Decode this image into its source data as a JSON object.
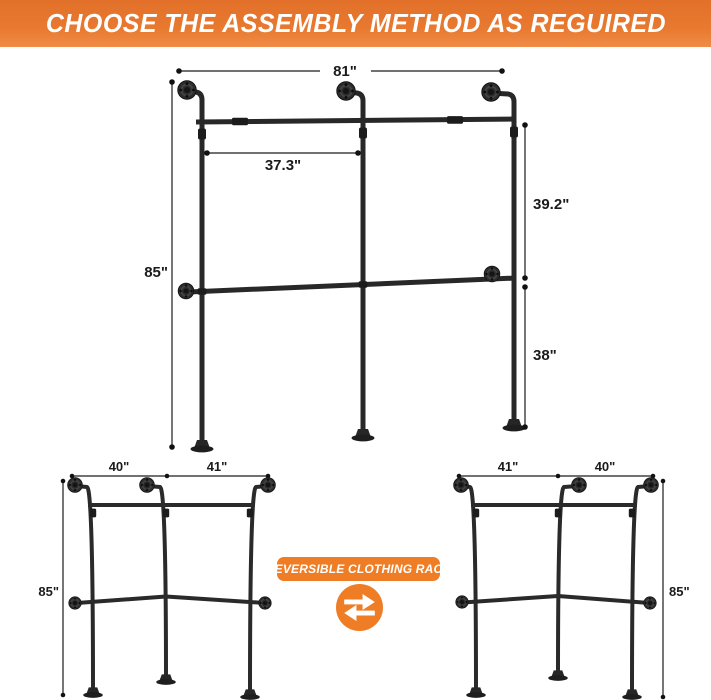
{
  "header": {
    "title": "CHOOSE THE ASSEMBLY METHOD AS REGUIRED"
  },
  "main_diagram": {
    "description": "wall-mounted industrial pipe clothing rack, straight 3-post layout",
    "total_width": "81\"",
    "rod_span": "37.3\"",
    "total_height": "85\"",
    "upper_section_height": "39.2\"",
    "lower_section_height": "38\""
  },
  "corner_left_diagram": {
    "description": "reversible corner assembly, left orientation",
    "left_span": "40\"",
    "right_span": "41\"",
    "height": "85\""
  },
  "corner_right_diagram": {
    "description": "reversible corner assembly, right orientation",
    "left_span": "41\"",
    "right_span": "40\"",
    "height": "85\""
  },
  "badge": {
    "label": "REVERSIBLE CLOTHING RACK"
  },
  "icons": {
    "swap_icon": "swap-arrows"
  },
  "colors": {
    "banner_orange": "#E8792F",
    "badge_orange": "#EE7D25",
    "pipe_black": "#282828",
    "dimension_color": "#1B1B1B",
    "background": "#FFFFFF"
  }
}
